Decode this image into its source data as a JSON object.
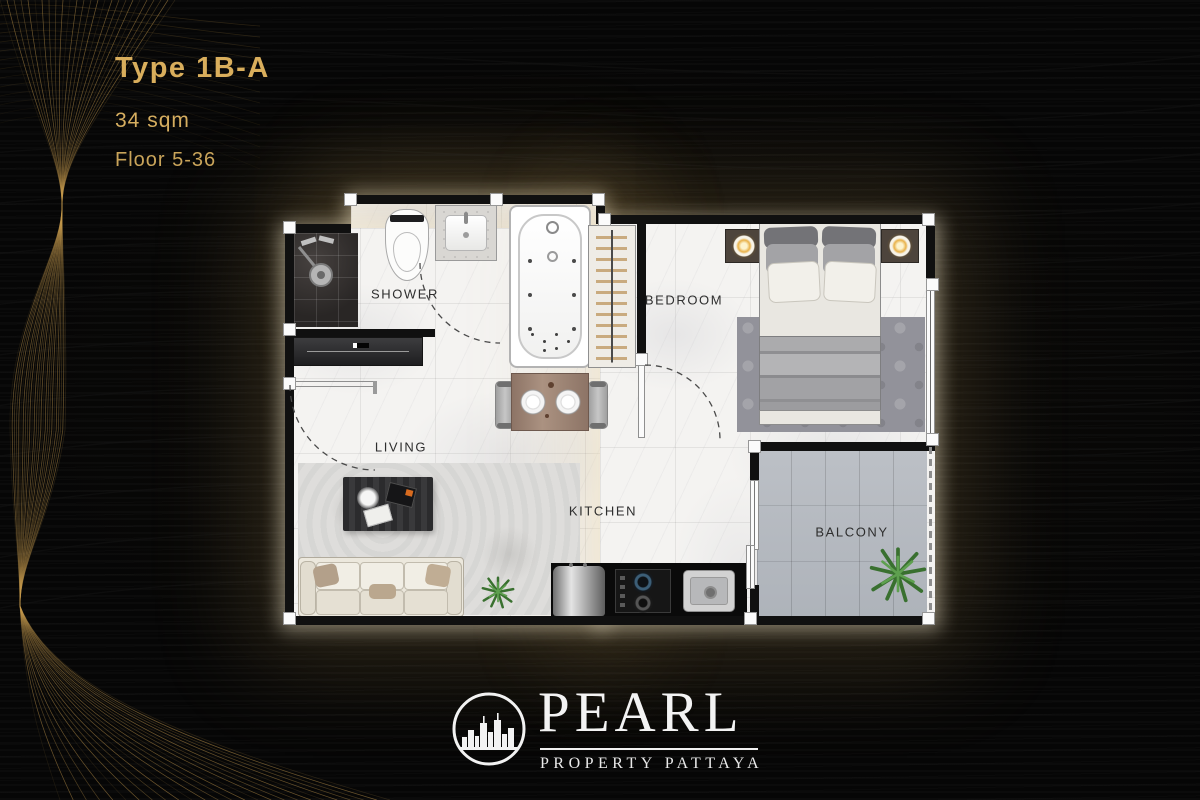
{
  "poster": {
    "background_color": "#060606",
    "accent_gold": "#d8ab58",
    "glow_color": "#e9d5a2"
  },
  "unit": {
    "type_label": "Type 1B-A",
    "area": "34 sqm",
    "floor_range": "Floor 5-36"
  },
  "floor_plan": {
    "rooms": [
      {
        "label": "SHOWER"
      },
      {
        "label": "BEDROOM"
      },
      {
        "label": "LIVING"
      },
      {
        "label": "KITCHEN"
      },
      {
        "label": "BALCONY"
      }
    ],
    "label_color": "#2e2e2e",
    "floor_color": "#f4f3f1",
    "wall_color": "#101010",
    "balcony_tile_color": "#b6bac0",
    "shower_tile_color": "#34302f"
  },
  "brand": {
    "name": "PEARL",
    "tagline": "PROPERTY PATTAYA",
    "logo_icon": "city-skyline-in-circle",
    "text_color": "#f2f2f2"
  }
}
